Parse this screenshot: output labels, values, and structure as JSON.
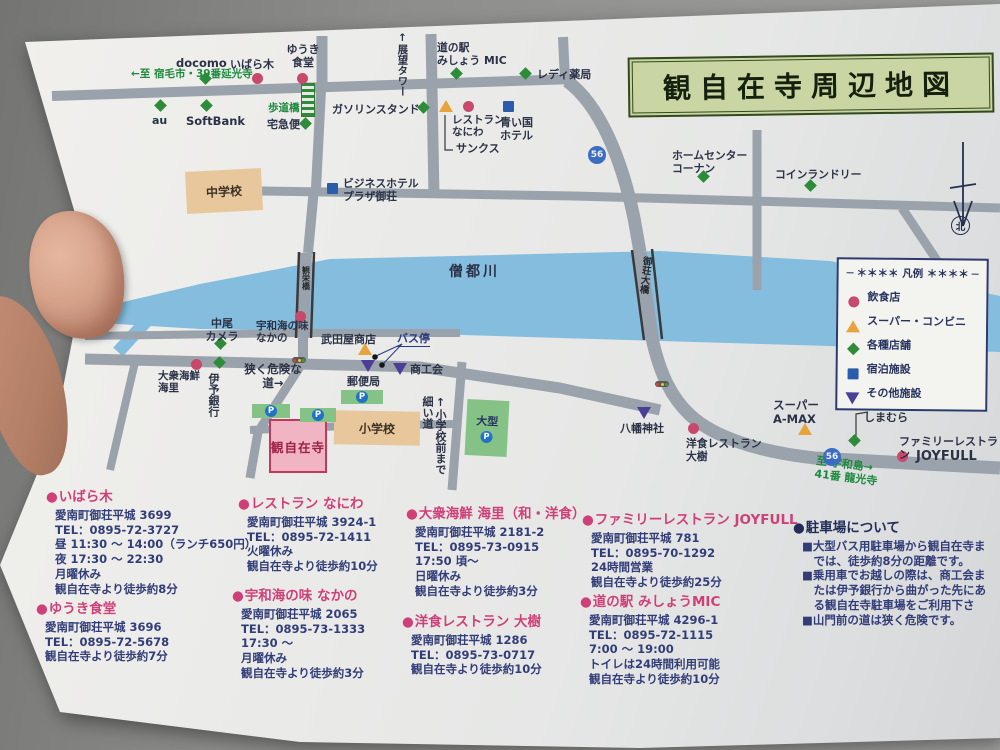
{
  "title": {
    "text": "観自在寺周辺地図"
  },
  "compass": {
    "label": "北"
  },
  "legend": {
    "title": "＊＊＊＊ 凡例 ＊＊＊＊",
    "items": [
      {
        "type": "eat",
        "label": "飲食店"
      },
      {
        "type": "conv",
        "label": "スーパー・コンビニ"
      },
      {
        "type": "shop",
        "label": "各種店舗"
      },
      {
        "type": "stay",
        "label": "宿泊施設"
      },
      {
        "type": "other",
        "label": "その他施設"
      }
    ]
  },
  "marker_colors": {
    "eat": "#c8496b",
    "conv": "#e8a33d",
    "shop": "#2e8b3a",
    "stay": "#2b5cab",
    "other": "#4a3f96"
  },
  "map": {
    "river_label": "僧都川",
    "bus_stop": {
      "label": "バス停"
    },
    "route_badges": [
      {
        "num": "56",
        "x": 588,
        "y": 146
      },
      {
        "num": "56",
        "x": 823,
        "y": 448
      }
    ],
    "traffic_lights": [
      {
        "x": 292,
        "y": 357
      },
      {
        "x": 655,
        "y": 381
      }
    ],
    "bridges": [
      {
        "name": "観栄橋",
        "x": 301,
        "y": 266,
        "s": 8,
        "rot": 0
      },
      {
        "name": "御荘大橋",
        "x": 639,
        "y": 256,
        "s": 9.5,
        "rot": 6
      }
    ],
    "buildings": [
      {
        "label": "中学校",
        "x": 186,
        "y": 170,
        "w": 76,
        "h": 42,
        "rot": -3,
        "kind": "tan"
      },
      {
        "label": "小学校",
        "x": 334,
        "y": 411,
        "w": 86,
        "h": 34,
        "rot": 1,
        "kind": "tan"
      },
      {
        "label": "観自在寺",
        "x": 269,
        "y": 419,
        "w": 54,
        "h": 50,
        "rot": 0,
        "kind": "temple"
      }
    ],
    "parkings": [
      {
        "x": 252,
        "y": 404,
        "w": 38,
        "h": 14,
        "rot": 0
      },
      {
        "x": 300,
        "y": 408,
        "w": 36,
        "h": 14,
        "rot": 0
      },
      {
        "x": 341,
        "y": 390,
        "w": 42,
        "h": 14,
        "rot": 0
      },
      {
        "x": 466,
        "y": 400,
        "w": 42,
        "h": 56,
        "rot": 3,
        "label": "大型"
      }
    ],
    "pois": [
      {
        "label": "docomo",
        "type": "shop",
        "mx": 207,
        "my": 80,
        "lx": 176,
        "ly": 57,
        "s": 11.5
      },
      {
        "label": "いばら木",
        "type": "eat",
        "mx": 258,
        "my": 79,
        "lx": 230,
        "ly": 59
      },
      {
        "label": "ゆうき\n食堂",
        "type": "eat",
        "mx": 303,
        "my": 79,
        "lx": 277,
        "ly": 44,
        "align": "center",
        "w": 52
      },
      {
        "label": "au",
        "type": "shop",
        "mx": 162,
        "my": 107,
        "lx": 152,
        "ly": 115
      },
      {
        "label": "SoftBank",
        "type": "shop",
        "mx": 208,
        "my": 107,
        "lx": 186,
        "ly": 115,
        "s": 11.5
      },
      {
        "label": "宅急便",
        "type": "shop",
        "mx": 307,
        "my": 125,
        "lx": 267,
        "ly": 119
      },
      {
        "label": "ガソリンスタンド",
        "type": "shop",
        "mx": 425,
        "my": 109,
        "lx": 332,
        "ly": 104
      },
      {
        "label": "道の駅\nみしょう MIC",
        "type": "shop",
        "mx": 458,
        "my": 75,
        "lx": 437,
        "ly": 42,
        "s": 10.8
      },
      {
        "label": "レディ薬局",
        "type": "shop",
        "mx": 527,
        "my": 75,
        "lx": 537,
        "ly": 69
      },
      {
        "label": "レストラン\nなにわ",
        "type": "eat",
        "mx": 469,
        "my": 107,
        "lx": 452,
        "ly": 114,
        "s": 10.5
      },
      {
        "label": "サンクス",
        "type": "conv",
        "mx": 445,
        "my": 106,
        "lx": 456,
        "ly": 143
      },
      {
        "label": "青い国\nホテル",
        "type": "stay",
        "mx": 509,
        "my": 107,
        "lx": 500,
        "ly": 117
      },
      {
        "label": "ホームセンター\nコーナン",
        "type": "shop",
        "mx": 705,
        "my": 178,
        "lx": 672,
        "ly": 150,
        "s": 10.8
      },
      {
        "label": "コインランドリー",
        "type": "shop",
        "mx": 812,
        "my": 187,
        "lx": 775,
        "ly": 169,
        "s": 10.8
      },
      {
        "label": "ビジネスホテル\nプラザ御荘",
        "type": "stay",
        "mx": 333,
        "my": 189,
        "lx": 343,
        "ly": 178,
        "s": 10.8
      },
      {
        "label": "中尾\nカメラ",
        "type": "shop",
        "mx": 222,
        "my": 345,
        "lx": 199,
        "ly": 318,
        "align": "center",
        "w": 46
      },
      {
        "label": "宇和海の味\nなかの",
        "type": "eat",
        "mx": 301,
        "my": 317,
        "lx": 256,
        "ly": 320,
        "s": 10.5
      },
      {
        "label": "武田屋商店",
        "type": "conv",
        "mx": 364,
        "my": 349,
        "lx": 321,
        "ly": 334
      },
      {
        "label": "大衆海鮮\n海里",
        "type": "eat",
        "mx": 197,
        "my": 365,
        "lx": 158,
        "ly": 370,
        "s": 10.5
      },
      {
        "label": "伊予銀行",
        "type": "shop",
        "mx": 221,
        "my": 364,
        "lx": 206,
        "ly": 373,
        "v": true
      },
      {
        "label": "郵便局",
        "type": "other",
        "mx": 367,
        "my": 366,
        "lx": 347,
        "ly": 376
      },
      {
        "label": "商工会",
        "type": "other",
        "mx": 399,
        "my": 369,
        "lx": 410,
        "ly": 364
      },
      {
        "label": "八幡神社",
        "type": "other",
        "mx": 643,
        "my": 413,
        "lx": 620,
        "ly": 423
      },
      {
        "label": "洋食レストラン\n大樹",
        "type": "eat",
        "mx": 694,
        "my": 429,
        "lx": 686,
        "ly": 438,
        "s": 10.8
      },
      {
        "label": "スーパー\nA-MAX",
        "type": "conv",
        "mx": 804,
        "my": 429,
        "lx": 773,
        "ly": 399,
        "s": 11.5
      },
      {
        "label": "ファッションセンター\nしまむら",
        "type": "shop",
        "mx": 856,
        "my": 442,
        "lx": 864,
        "ly": 399
      },
      {
        "label": "JOYFULL",
        "type": "eat",
        "mx": 903,
        "my": 457,
        "lx": 916,
        "ly": 449,
        "s": 13
      }
    ],
    "texts": [
      {
        "t": "←至 宿毛市・39番延光寺",
        "x": 131,
        "y": 68,
        "c": "green",
        "s": 10.5
      },
      {
        "t": "歩道橋",
        "x": 268,
        "y": 102,
        "c": "green",
        "s": 10.5
      },
      {
        "t": "↑展望タワー",
        "x": 396,
        "y": 32,
        "c": "navy",
        "s": 10.5,
        "v": true
      },
      {
        "t": "僧都川",
        "x": 449,
        "y": 264,
        "c": "navy",
        "s": 14,
        "ls": 3
      },
      {
        "t": "狭く危険な\n道→",
        "x": 241,
        "y": 363,
        "c": "navy",
        "s": 11.5,
        "align": "center",
        "w": 64
      },
      {
        "t": "↑小学校前まで\n細い道",
        "x": 420,
        "y": 396,
        "c": "navy",
        "s": 11,
        "v": true
      },
      {
        "t": "至 宇和島→\n41番 龍光寺",
        "x": 815,
        "y": 459,
        "c": "green",
        "s": 11,
        "rot": 7
      },
      {
        "t": "ファミリーレストラン",
        "x": 899,
        "y": 436,
        "c": "navy",
        "s": 11
      }
    ]
  },
  "listings": [
    {
      "style": "pink",
      "x": 46,
      "y": 485,
      "heading": "いばら木",
      "lines": [
        "愛南町御荘平城 3699",
        "TEL：0895-72-3727",
        "昼 11:30 ～ 14:00（ランチ650円）",
        "夜 17:30 ～ 22:30",
        "月曜休み",
        "観自在寺より徒歩約8分"
      ]
    },
    {
      "style": "pink",
      "x": 36,
      "y": 597,
      "heading": "ゆうき食堂",
      "lines": [
        "愛南町御荘平城 3696",
        "TEL：0895-72-5678",
        "観自在寺より徒歩約7分"
      ]
    },
    {
      "style": "pink",
      "x": 238,
      "y": 492,
      "heading": "レストラン なにわ",
      "lines": [
        "愛南町御荘平城 3924-1",
        "TEL：0895-72-1411",
        "火曜休み",
        "観自在寺より徒歩約10分"
      ]
    },
    {
      "style": "pink",
      "x": 232,
      "y": 584,
      "heading": "宇和海の味 なかの",
      "lines": [
        "愛南町御荘平城 2065",
        "TEL：0895-73-1333",
        "17:30 ～",
        "月曜休み",
        "観自在寺より徒歩約3分"
      ]
    },
    {
      "style": "pink",
      "x": 406,
      "y": 502,
      "heading": "大衆海鮮 海里（和・洋食）",
      "lines": [
        "愛南町御荘平城 2181-2",
        "TEL：0895-73-0915",
        "17:50 頃～",
        "日曜休み",
        "観自在寺より徒歩約3分"
      ]
    },
    {
      "style": "pink",
      "x": 402,
      "y": 610,
      "heading": "洋食レストラン 大樹",
      "lines": [
        "愛南町御荘平城 1286",
        "TEL：0895-73-0717",
        "観自在寺より徒歩約10分"
      ]
    },
    {
      "style": "pink",
      "x": 582,
      "y": 508,
      "heading": "ファミリーレストラン JOYFULL",
      "lines": [
        "愛南町御荘平城 781",
        "TEL：0895-70-1292",
        "24時間営業",
        "観自在寺より徒歩約25分"
      ]
    },
    {
      "style": "pink",
      "x": 580,
      "y": 590,
      "heading": "道の駅 みしょうMIC",
      "lines": [
        "愛南町御荘平城 4296-1",
        "TEL：0895-72-1115",
        "7:00 ～ 19:00",
        "トイレは24時間利用可能",
        "観自在寺より徒歩約10分"
      ]
    },
    {
      "style": "navy",
      "x": 793,
      "y": 516,
      "heading": "駐車場について",
      "lines": [
        "■大型バス用駐車場から観自在寺ま",
        "　では、徒歩約8分の距離です。",
        "■乗用車でお越しの際は、商工会ま",
        "　たは伊予銀行から曲がった先にあ",
        "　る観自在寺駐車場をご利用下さ",
        "■山門前の道は狭く危険です。"
      ]
    }
  ]
}
